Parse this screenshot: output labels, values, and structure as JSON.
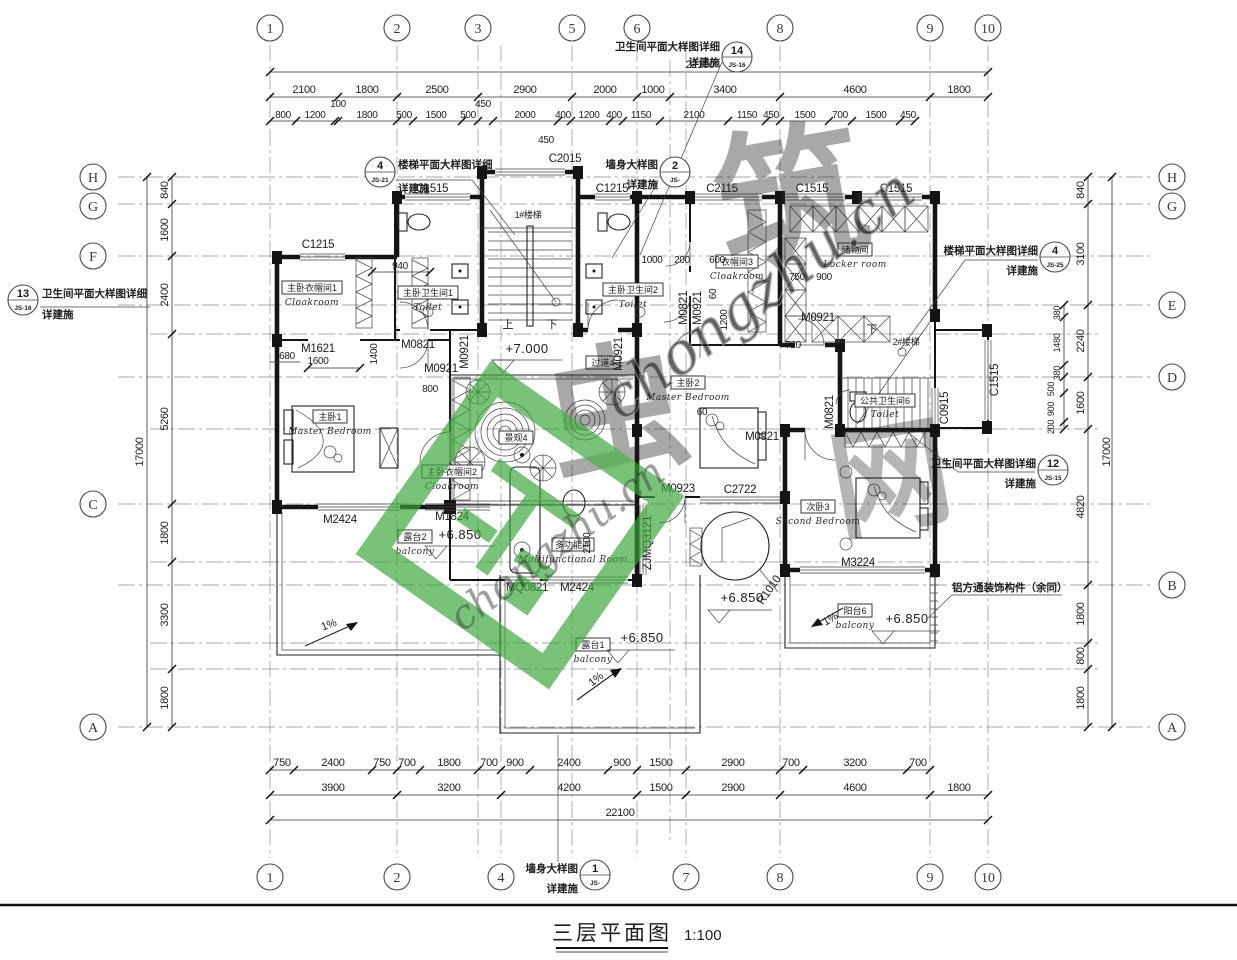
{
  "meta": {
    "drawing_title": "三层平面图",
    "scale": "1:100"
  },
  "watermark": {
    "char1": "虫",
    "char2": "筑",
    "char3": "网",
    "cursive": "chongzhu.cn",
    "green": "#3aa43a"
  },
  "grid": {
    "top": [
      "1",
      "2",
      "3",
      "5",
      "6",
      "8",
      "9",
      "10"
    ],
    "bottom": [
      "1",
      "2",
      "4",
      "7",
      "8",
      "9",
      "10"
    ],
    "left": [
      "H",
      "G",
      "F",
      "C",
      "A"
    ],
    "right": [
      "H",
      "G",
      "E",
      "D",
      "B",
      "A"
    ]
  },
  "dims": {
    "overall_h": "22100",
    "overall_v": "17000",
    "top1": [
      "2100",
      "1800",
      "2500",
      "2900",
      "2000",
      "1000",
      "3400",
      "4600",
      "1800"
    ],
    "top2": [
      "800",
      "1200",
      "100",
      "1800",
      "500",
      "1500",
      "500",
      "450",
      "2000",
      "400",
      "1200",
      "400",
      "1150",
      "2100",
      "1150",
      "450",
      "1500",
      "700",
      "1500",
      "450"
    ],
    "top_extra450": "450",
    "bot1": [
      "750",
      "2400",
      "750",
      "700",
      "1800",
      "700",
      "900",
      "2400",
      "900",
      "1500",
      "2900",
      "700",
      "3200",
      "700"
    ],
    "bot2": [
      "3900",
      "3200",
      "4200",
      "1500",
      "2900",
      "4600",
      "1800"
    ],
    "left": [
      "840",
      "1600",
      "2400",
      "5260",
      "1800",
      "3300",
      "1800"
    ],
    "right": [
      "840",
      "3100",
      "2240",
      "1600",
      "4820",
      "1800",
      "800",
      "1800"
    ],
    "right_sub1": [
      "380",
      "1480",
      "380"
    ],
    "right_sub2": [
      "500",
      "900",
      "200"
    ],
    "interior": {
      "d940": "940",
      "d680": "680",
      "d1600": "1600",
      "d1400": "1400",
      "d800": "800",
      "d1000": "1000",
      "d200": "200",
      "d600": "600",
      "d1200": "1200",
      "d60": "60",
      "d750": "750",
      "d900": "900",
      "d720": "720",
      "d2100": "2100"
    }
  },
  "codes": {
    "c2015": "C2015",
    "c1515": "C1515",
    "c1215": "C1215",
    "c2115": "C2115",
    "c0915": "C0915",
    "c2722": "C2722",
    "m1621": "M1621",
    "m0821": "M0821",
    "m0921": "M0921",
    "m0923": "M0923",
    "m1824": "M1824",
    "m2424": "M2424",
    "m3224": "M3224",
    "mq0821": "MQ0821",
    "zjmq3121": "ZJMQ3121",
    "r1010": "R1010"
  },
  "rooms": {
    "master1": {
      "zh": "主卧1",
      "en": "Master Bedroom"
    },
    "cloak1": {
      "zh": "主卧衣帽间1",
      "en": "Cloakroom"
    },
    "toilet1": {
      "zh": "主卧卫生间1",
      "en": "Toilet"
    },
    "toilet2": {
      "zh": "主卧卫生间2",
      "en": "Toilet"
    },
    "master2": {
      "zh": "主卧2",
      "en": "Master Bedroom"
    },
    "cloak3": {
      "zh": "衣帽间3",
      "en": "Cloakroom"
    },
    "locker": {
      "zh": "储物间",
      "en": "Locker room"
    },
    "toilet6": {
      "zh": "公共卫生间6",
      "en": "Toilet"
    },
    "bed3": {
      "zh": "次卧3",
      "en": "Second Bedroom"
    },
    "corridor": {
      "zh": "过道4",
      "en": ""
    },
    "multi": {
      "zh": "多功能间",
      "en": "Multifunctional Room"
    },
    "cloak2": {
      "zh": "主卧衣帽间2",
      "en": "Cloakroom"
    },
    "terrace1": {
      "zh": "露台1",
      "en": "balcony"
    },
    "terrace2": {
      "zh": "露台2",
      "en": "balcony"
    },
    "balcony6": {
      "zh": "阳台6",
      "en": "balcony"
    },
    "landscape": {
      "zh": "景观4",
      "en": ""
    }
  },
  "stairs": {
    "s1": "1#楼梯",
    "s2": "2#楼梯",
    "up": "上",
    "down": "下"
  },
  "levels": {
    "hall": "+7.000",
    "terrace": "+6.850",
    "slope": "1%"
  },
  "annotations": {
    "toilet_detail": "卫生间平面大样图详细",
    "stair_detail": "楼梯平面大样图详细",
    "wall_detail": "墙身大样图",
    "see_note": "详建施",
    "aluminum": "铝方通装饰构件（余同）",
    "b14": {
      "num": "14",
      "sheet": "JS-16"
    },
    "b4t": {
      "num": "4",
      "sheet": "JS-21"
    },
    "b2": {
      "num": "2",
      "sheet": "JS-"
    },
    "b4r": {
      "num": "4",
      "sheet": "JS-25"
    },
    "b12": {
      "num": "12",
      "sheet": "JS-15"
    },
    "b13": {
      "num": "13",
      "sheet": "JS-16"
    },
    "b1": {
      "num": "1",
      "sheet": "JS-"
    }
  }
}
